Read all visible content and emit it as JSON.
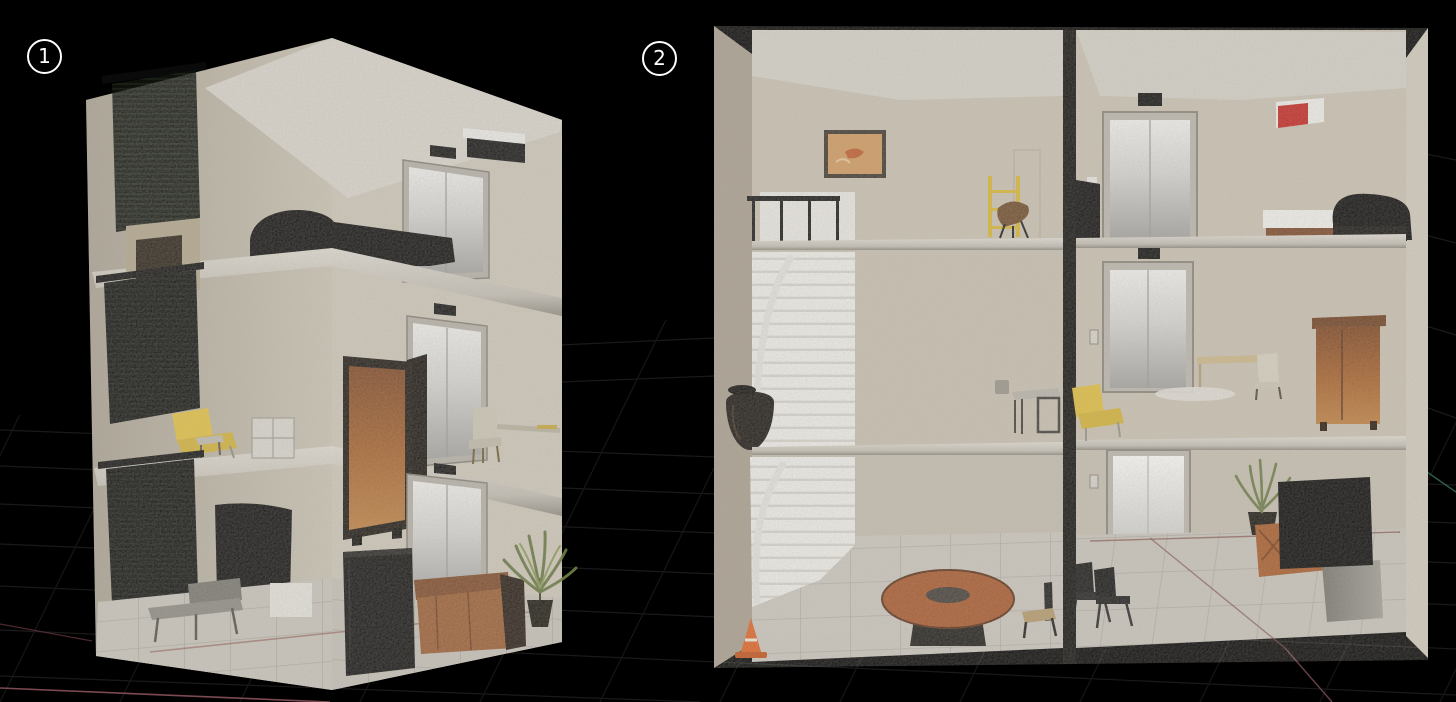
{
  "views": [
    {
      "label": "1",
      "name": "isometric-three-story-dollhouse-cutaway",
      "floors": [
        {
          "name": "top-floor",
          "objects": [
            "window-blinds",
            "storage-shelf",
            "double-bed",
            "elevator",
            "air-conditioner"
          ]
        },
        {
          "name": "middle-floor",
          "objects": [
            "window-blinds",
            "lounge-chair",
            "side-stool",
            "cube-shelf",
            "wardrobe",
            "elevator",
            "desk-chair",
            "wall-desk"
          ]
        },
        {
          "name": "ground-floor",
          "objects": [
            "window-blinds",
            "wall-tv",
            "bench",
            "storage-box",
            "refrigerator",
            "elevator",
            "leather-sofa",
            "potted-plant"
          ]
        }
      ]
    },
    {
      "label": "2",
      "name": "front-facing-two-column-building-cutaway",
      "columns": [
        {
          "name": "left-column",
          "rooms": [
            {
              "name": "top-room",
              "objects": [
                "framed-painting",
                "stair-railing",
                "staircase-top",
                "ladder-shelf",
                "wooden-chair"
              ]
            },
            {
              "name": "middle-room",
              "objects": [
                "staircase",
                "floor-vase",
                "side-table",
                "cup"
              ]
            },
            {
              "name": "bottom-room",
              "objects": [
                "staircase",
                "traffic-cone",
                "round-table",
                "chair"
              ]
            }
          ]
        },
        {
          "name": "right-column",
          "rooms": [
            {
              "name": "top-room",
              "objects": [
                "television",
                "elevator",
                "air-conditioner",
                "single-bed"
              ]
            },
            {
              "name": "middle-room",
              "objects": [
                "elevator",
                "lounge-chair",
                "console-table",
                "chair",
                "armoire",
                "rug"
              ]
            },
            {
              "name": "bottom-room",
              "objects": [
                "elevator",
                "waiting-chairs",
                "potted-plant",
                "wooden-sofa",
                "television",
                "tv-stand"
              ]
            }
          ]
        }
      ]
    }
  ],
  "palette": {
    "background": "#000000",
    "wall": "#cbc3b4",
    "ceiling": "#d9d5cd",
    "floor": "#c9c5bd",
    "blinds": "#0c0e0a",
    "elevator_door": "#d9d9d7",
    "accent_yellow": "#e0bd3c",
    "wood_brown": "#a05a2e",
    "black_objects": "#070707",
    "ac_red": "#c42420",
    "cone_orange": "#e06224",
    "grid_line": "#1a1a1a",
    "red_guide_line": "#7b4a52",
    "teal_guide_line": "#2c5c48"
  }
}
